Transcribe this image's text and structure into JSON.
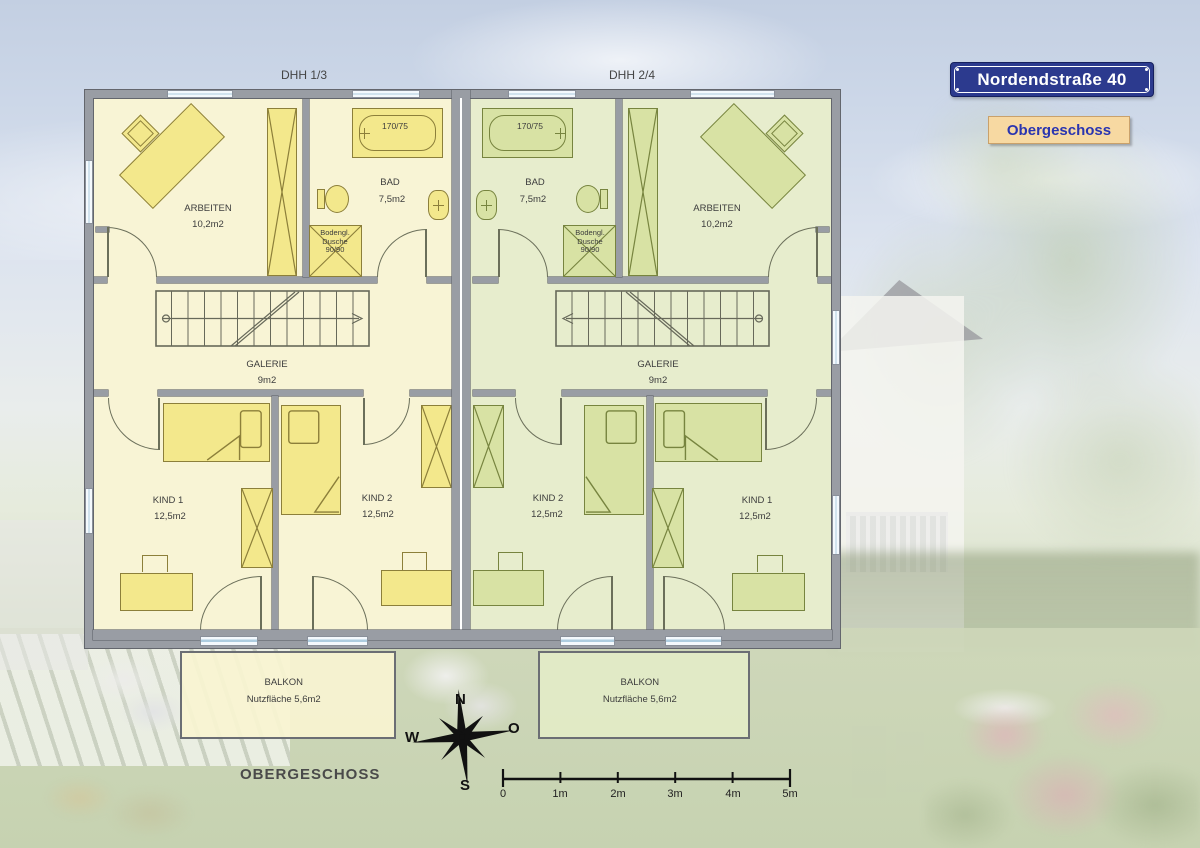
{
  "header": {
    "dhh_left": "DHH 1/3",
    "dhh_right": "DHH 2/4"
  },
  "sign": {
    "text": "Nordendstraße 40",
    "button": "Obergeschoss"
  },
  "units": {
    "left": {
      "arbeiten": {
        "name": "ARBEITEN",
        "area": "10,2m2"
      },
      "bad": {
        "name": "BAD",
        "area": "7,5m2"
      },
      "tub": "170/75",
      "shower": {
        "line1": "Bodengl.",
        "line2": "Dusche",
        "line3": "90/90"
      },
      "galerie": {
        "name": "GALERIE",
        "area": "9m2"
      },
      "kind1": {
        "name": "KIND 1",
        "area": "12,5m2"
      },
      "kind2": {
        "name": "KIND 2",
        "area": "12,5m2"
      },
      "balkon": {
        "name": "BALKON",
        "area": "Nutzfläche 5,6m2"
      }
    },
    "right": {
      "arbeiten": {
        "name": "ARBEITEN",
        "area": "10,2m2"
      },
      "bad": {
        "name": "BAD",
        "area": "7,5m2"
      },
      "tub": "170/75",
      "shower": {
        "line1": "Bodengl.",
        "line2": "Dusche",
        "line3": "90/90"
      },
      "galerie": {
        "name": "GALERIE",
        "area": "9m2"
      },
      "kind1": {
        "name": "KIND 1",
        "area": "12,5m2"
      },
      "kind2": {
        "name": "KIND 2",
        "area": "12,5m2"
      },
      "balkon": {
        "name": "BALKON",
        "area": "Nutzfläche 5,6m2"
      }
    }
  },
  "footer": {
    "floor_label": "OBERGESCHOSS"
  },
  "compass": {
    "n": "N",
    "w": "W",
    "o": "O",
    "s": "S"
  },
  "scale": {
    "ticks": [
      "0",
      "1m",
      "2m",
      "3m",
      "4m",
      "5m"
    ]
  },
  "colors": {
    "wall": "#999da4",
    "wall_edge": "#63666d",
    "unit_left_fill": "#f8f4d5",
    "unit_right_fill": "#e7edcd",
    "furn_left": "#f3e88c",
    "furn_right": "#d8e2a4",
    "stroke_left": "#8c7f3a",
    "stroke_right": "#77843f",
    "door": "#6b6f5a",
    "sign_bg": "#2c3a8e",
    "sign_text": "#ffffff",
    "button_bg": "#f7d9a2",
    "button_text": "#2a35b0",
    "label_text": "#3d3d3d"
  }
}
